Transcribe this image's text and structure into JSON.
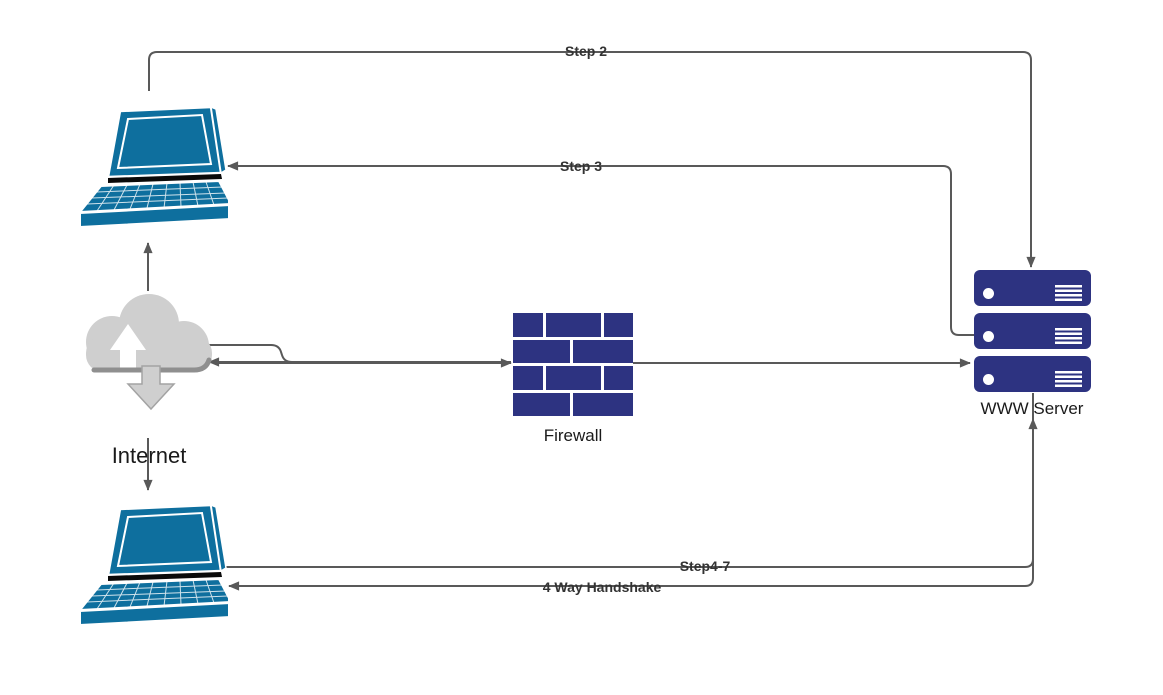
{
  "nodes": {
    "laptop_top": {
      "icon": "laptop-icon"
    },
    "internet": {
      "icon": "cloud-icon",
      "label": "Internet"
    },
    "firewall": {
      "icon": "brick-wall-icon",
      "label": "Firewall"
    },
    "server": {
      "icon": "server-stack-icon",
      "label": "WWW Server",
      "units": 3
    },
    "laptop_bottom": {
      "icon": "laptop-icon"
    }
  },
  "connectors": {
    "step2": {
      "label": "Step 2",
      "from": "laptop_top",
      "to": "server"
    },
    "step3": {
      "label": "Step 3",
      "from": "server",
      "to": "laptop_top"
    },
    "internet_up": {
      "label": "",
      "from": "internet",
      "to": "laptop_top"
    },
    "internet_down": {
      "label": "",
      "from": "internet",
      "to": "laptop_bottom"
    },
    "internet_firewall": {
      "label": "",
      "from": "internet",
      "to": "firewall",
      "bidirectional": true
    },
    "firewall_server": {
      "label": "",
      "from": "firewall",
      "to": "server"
    },
    "step4_7": {
      "label": "Step4-7",
      "from": "laptop_bottom",
      "to": "server"
    },
    "handshake": {
      "label": "4 Way Handshake",
      "from": "server",
      "to": "laptop_bottom"
    }
  },
  "colors": {
    "bg": "#ffffff",
    "line": "#595959",
    "navy": "#2d3381",
    "laptop": "#0e6f9e",
    "cloud": "#cfcfcf",
    "rim": "#8f8f8f",
    "step_label": "#333333",
    "device_label": "#1a1a1a"
  }
}
